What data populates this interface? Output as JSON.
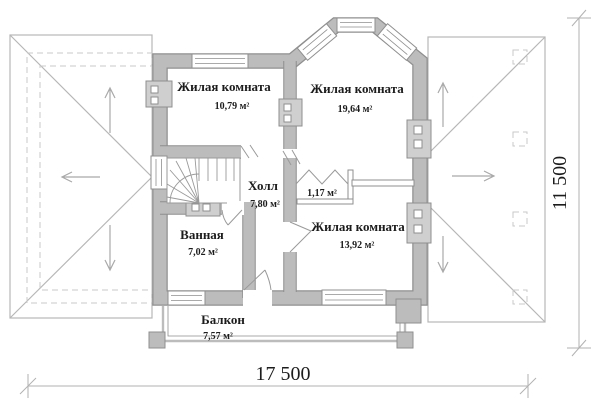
{
  "plan": {
    "type": "floor-plan",
    "rooms": [
      {
        "id": "living-1",
        "name": "Жилая комната",
        "area": "10,79 м²"
      },
      {
        "id": "living-2",
        "name": "Жилая комната",
        "area": "19,64 м²"
      },
      {
        "id": "hall",
        "name": "Холл",
        "area": "7,80 м²"
      },
      {
        "id": "closet",
        "name": "",
        "area": "1,17 м²"
      },
      {
        "id": "bathroom",
        "name": "Ванная",
        "area": "7,02 м²"
      },
      {
        "id": "living-3",
        "name": "Жилая комната",
        "area": "13,92 м²"
      },
      {
        "id": "balcony",
        "name": "Балкон",
        "area": "7,57 м²"
      }
    ],
    "dimensions": {
      "overall_width": "17 500",
      "overall_height": "11 500"
    },
    "colors": {
      "wall_fill": "#bcbcbc",
      "wall_outline": "#8f8f8f",
      "roof_line": "#b7b7b7",
      "dash_line": "#c9c9c9",
      "arrow": "#a9a9a9",
      "dim_line": "#b2b2b2",
      "text": "#1c1c1c"
    }
  }
}
